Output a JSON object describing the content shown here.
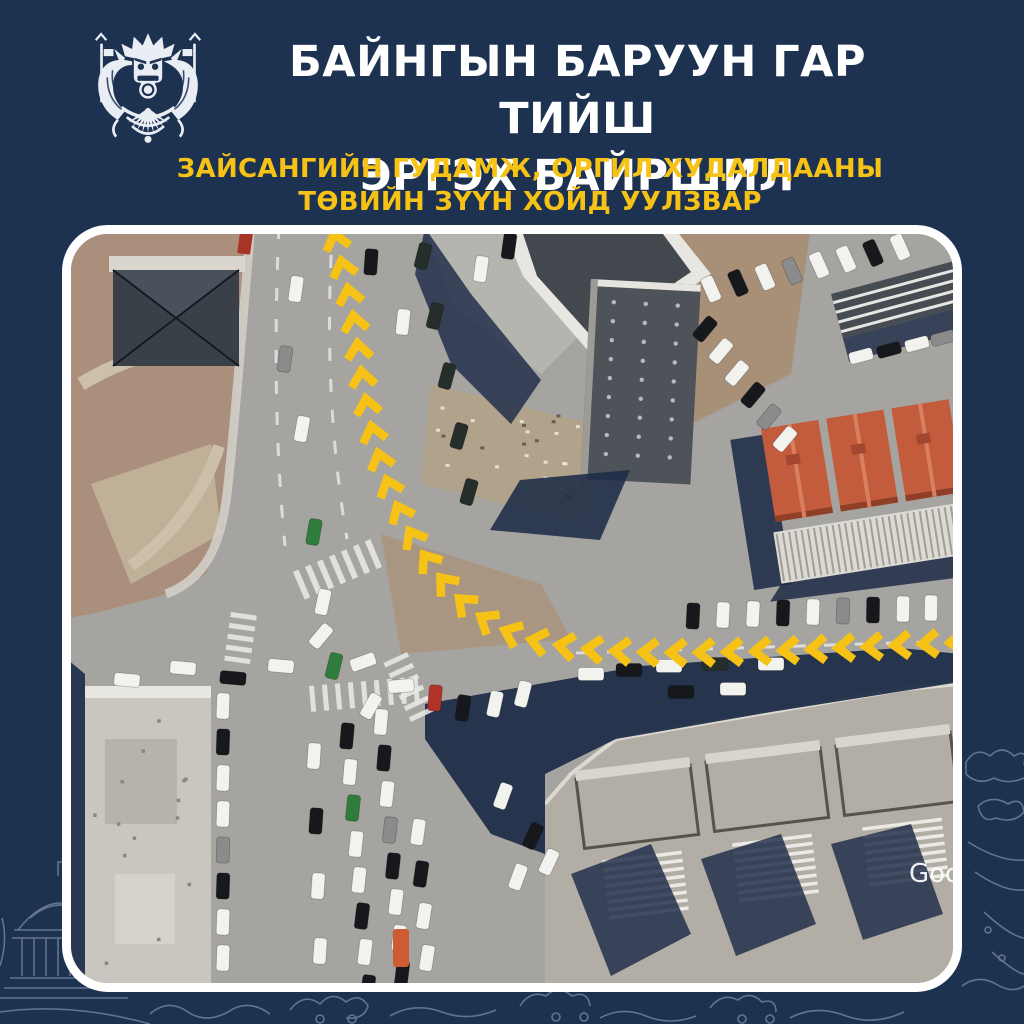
{
  "header": {
    "logo": "traffic-police-emblem",
    "title_line1": "БАЙНГЫН БАРУУН ГАР ТИЙШ",
    "title_line2": "ЭРГЭХ БАЙРШИЛ",
    "subtitle_line1": "ЗАЙСАНГИЙН ГУДАМЖ, ОРГИЛ ХУДАЛДААНЫ",
    "subtitle_line2": "ТӨВИЙН ЗҮҮН ХОЙД УУЛЗВАР"
  },
  "colors": {
    "background_navy": "#1d3150",
    "title_white": "#ffffff",
    "accent_yellow": "#f6c215",
    "route_arrow_yellow": "#f6c215",
    "shadow_navy": "#1d2b47"
  },
  "map": {
    "kind": "satellite-aerial-view",
    "subject": "intersection with permanent right-turn route marked by yellow chevron arrows",
    "watermark": "Google"
  }
}
